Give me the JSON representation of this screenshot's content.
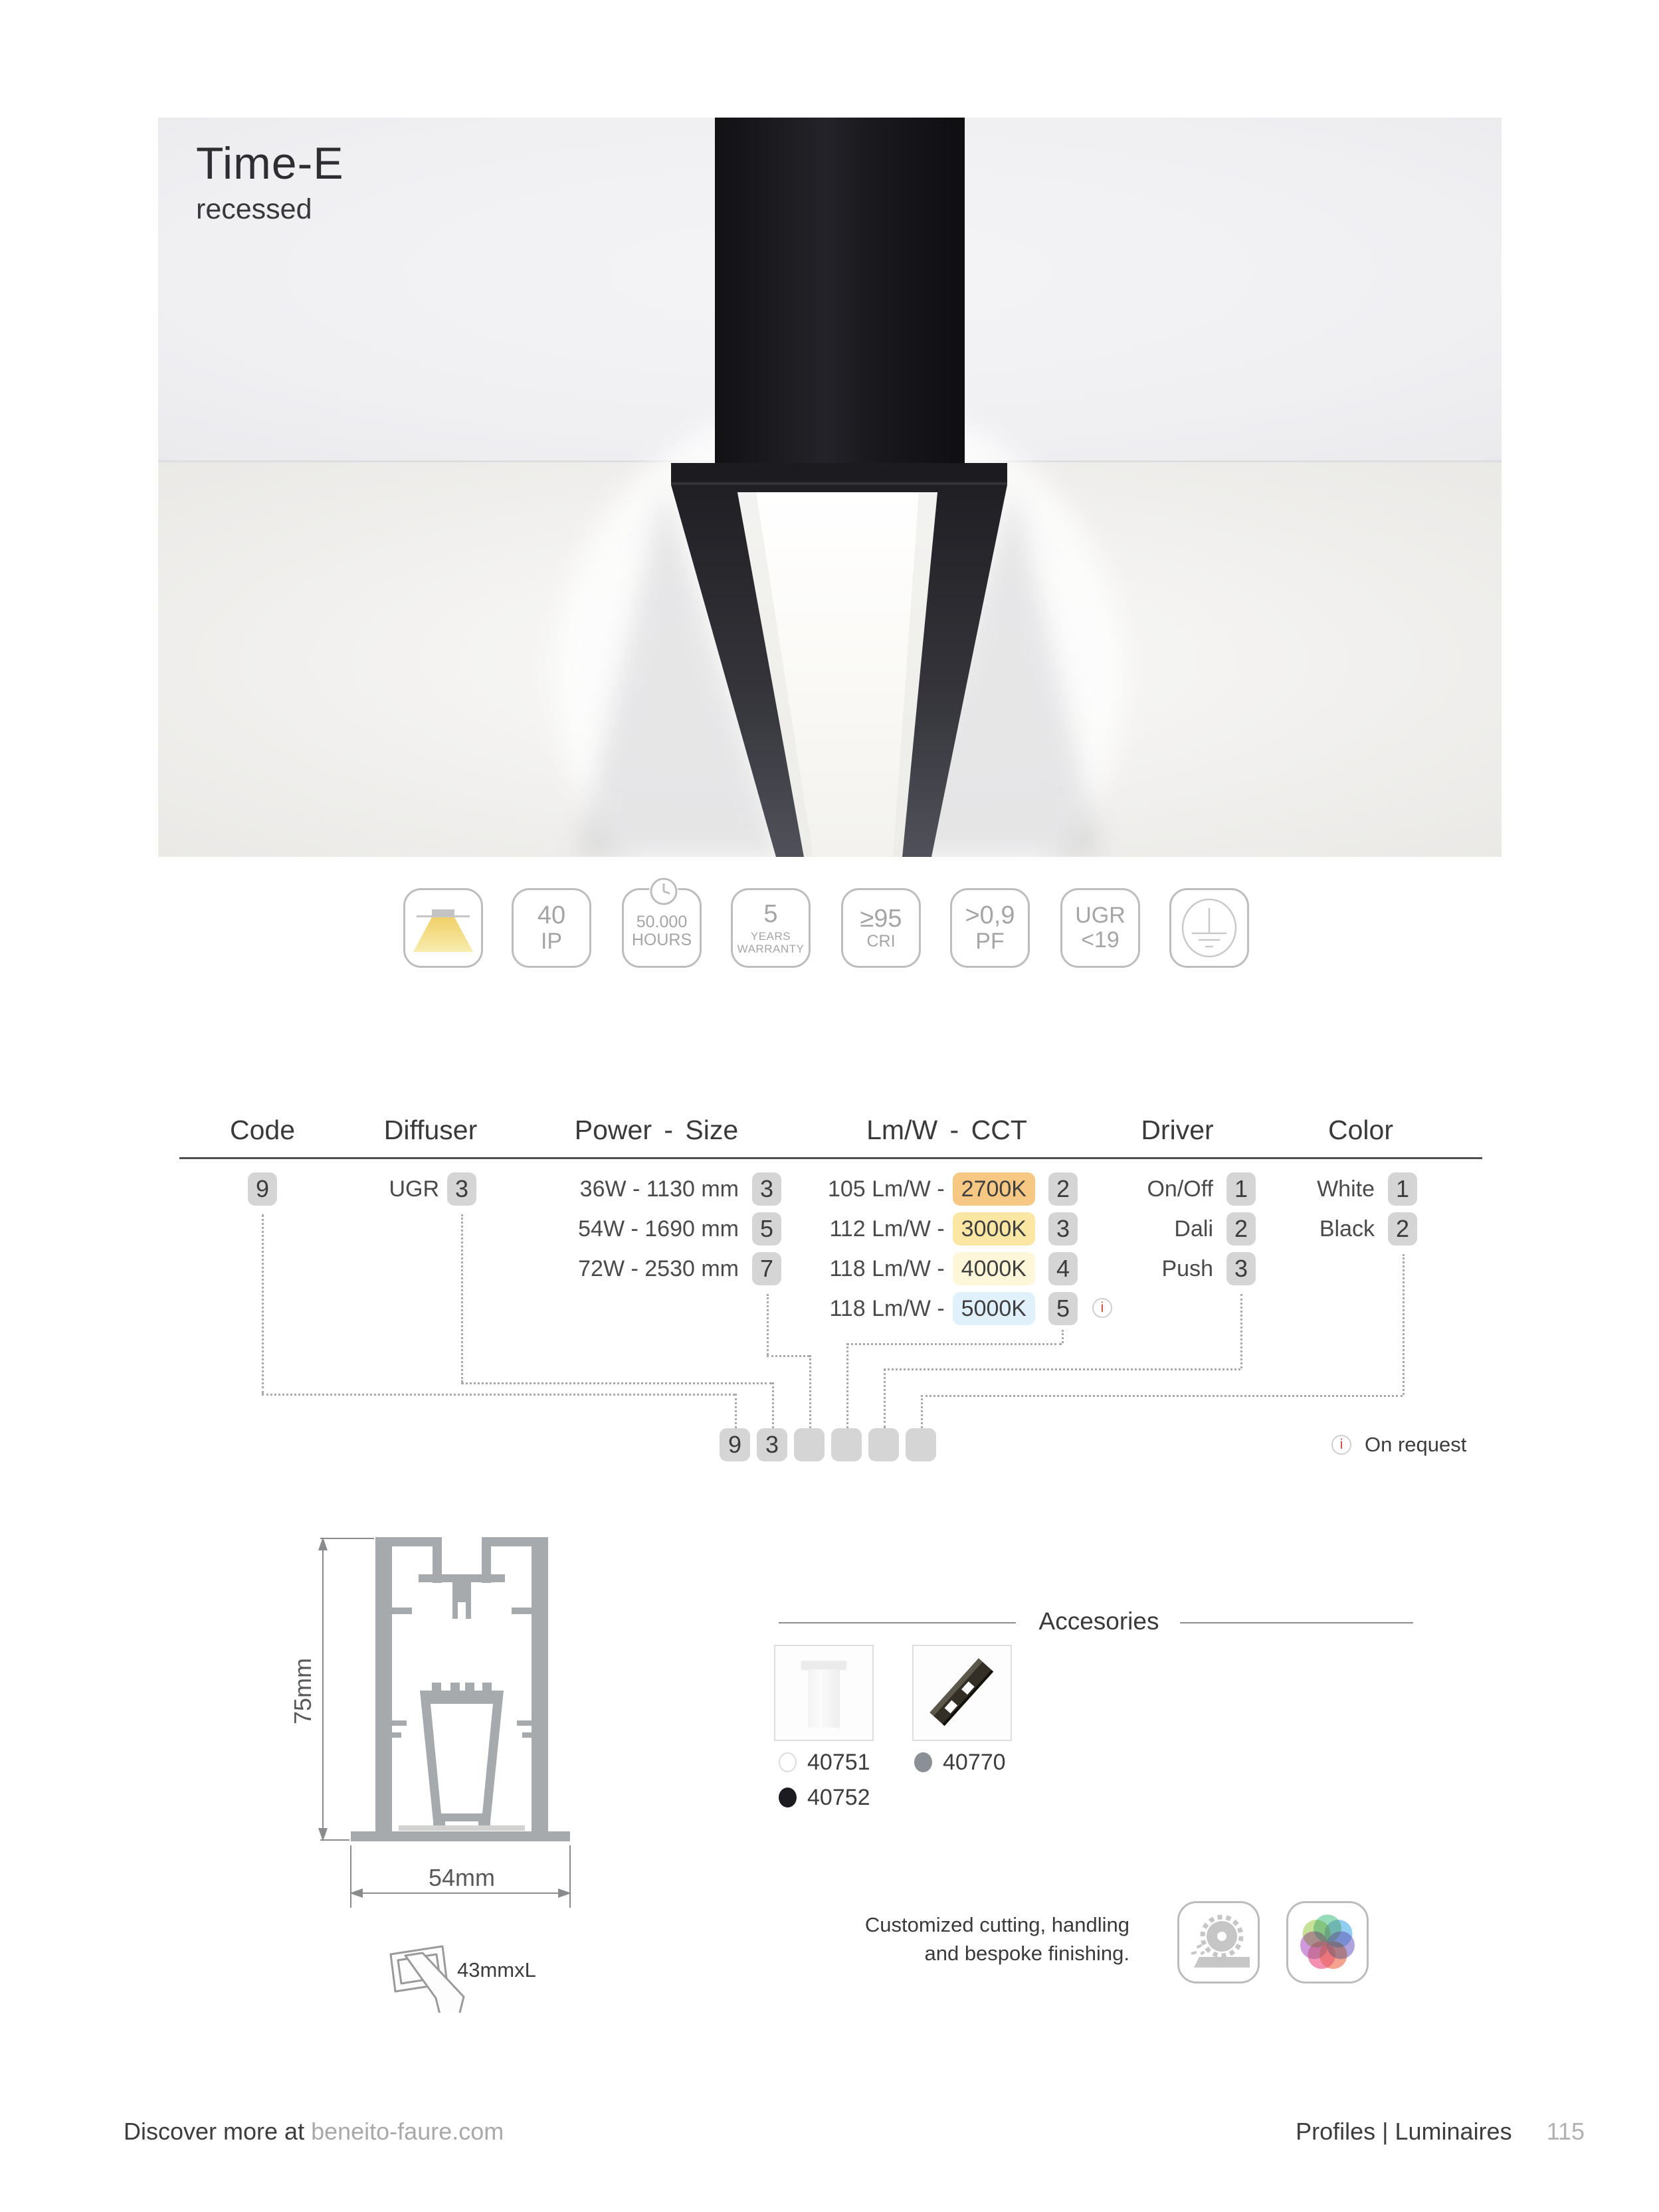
{
  "hero": {
    "title": "Time-E",
    "subtitle": "recessed"
  },
  "icons": {
    "recessed_light": "recessed-light-icon",
    "clock": "clock-icon",
    "ground": "ground-earth-icon",
    "info": "info-icon",
    "cut": "cut-to-size-icon",
    "saw": "circular-saw-icon",
    "color_wheel": "color-wheel-icon"
  },
  "badges": {
    "ip": {
      "line1": "40",
      "line2": "IP"
    },
    "hours": {
      "line1": "50.000",
      "line2": "HOURS"
    },
    "warranty": {
      "line1": "5",
      "line2": "YEARS",
      "line3": "WARRANTY"
    },
    "cri": {
      "line1": "≥95",
      "line2": "CRI"
    },
    "pf": {
      "line1": ">0,9",
      "line2": "PF"
    },
    "ugr": {
      "line1": "UGR",
      "line2": "<19"
    }
  },
  "table": {
    "headers": {
      "code": "Code",
      "diffuser": "Diffuser",
      "power": "Power - Size",
      "lmw": "Lm/W - CCT",
      "driver": "Driver",
      "color": "Color"
    },
    "code": {
      "value": "9"
    },
    "diffuser": {
      "label": "UGR",
      "value": "3"
    },
    "power": [
      {
        "label": "36W - 1130 mm",
        "code": "3"
      },
      {
        "label": "54W - 1690 mm",
        "code": "5"
      },
      {
        "label": "72W - 2530 mm",
        "code": "7"
      }
    ],
    "lmw": [
      {
        "label": "105 Lm/W -",
        "cct": "2700K",
        "code": "2",
        "color": "#f6c883"
      },
      {
        "label": "112 Lm/W -",
        "cct": "3000K",
        "code": "3",
        "color": "#fbe7a3"
      },
      {
        "label": "118 Lm/W -",
        "cct": "4000K",
        "code": "4",
        "color": "#fdf6d8"
      },
      {
        "label": "118 Lm/W -",
        "cct": "5000K",
        "code": "5",
        "color": "#e1f1fb"
      }
    ],
    "driver": [
      {
        "label": "On/Off",
        "code": "1"
      },
      {
        "label": "Dali",
        "code": "2"
      },
      {
        "label": "Push",
        "code": "3"
      }
    ],
    "color": [
      {
        "label": "White",
        "code": "1"
      },
      {
        "label": "Black",
        "code": "2"
      }
    ],
    "builder": [
      "9",
      "3",
      "",
      "",
      "",
      ""
    ],
    "on_request": "On request",
    "info_glyph": "i"
  },
  "drawing": {
    "height_label": "75mm",
    "width_label": "54mm",
    "cut_label": "43mmxL"
  },
  "accessories": {
    "title": "Accesories",
    "items": [
      {
        "code": "40751",
        "swatch": "#ffffff"
      },
      {
        "code": "40752",
        "swatch": "#1b1b20"
      },
      {
        "code": "40770",
        "swatch": "#8a9095"
      }
    ]
  },
  "services": {
    "line1": "Customized cutting, handling",
    "line2": "and bespoke finishing."
  },
  "footer": {
    "left_prefix": "Discover more at ",
    "left_link": "beneito-faure.com",
    "right": "Profiles | Luminaires",
    "page_number": "115"
  }
}
